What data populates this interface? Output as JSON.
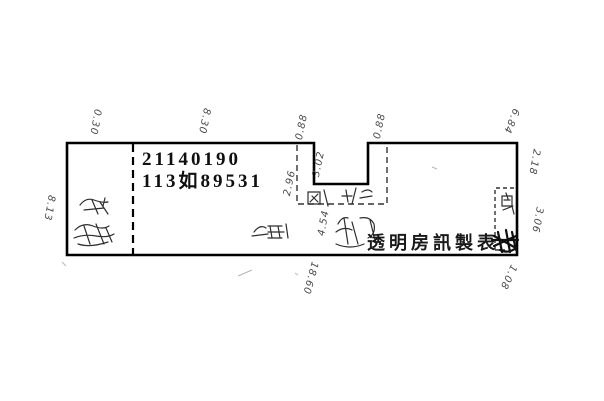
{
  "page": {
    "background_color": "#ffffff",
    "line_color": "#000000",
    "annotation_color": "#4a4a4a"
  },
  "parcel": {
    "id_line1": "21140190",
    "id_line2": "113如89531",
    "stamp": "透明房訊製表"
  },
  "measurements": [
    {
      "name": "top-left-segment",
      "value": "0.30"
    },
    {
      "name": "top-main-segment",
      "value": "8.30"
    },
    {
      "name": "notch-left-top",
      "value": "0.88"
    },
    {
      "name": "notch-right-top",
      "value": "0.88"
    },
    {
      "name": "top-right-segment",
      "value": "6.84"
    },
    {
      "name": "notch-depth",
      "value": "3.02"
    },
    {
      "name": "notch-area-left",
      "value": "2.96"
    },
    {
      "name": "notch-area-bottom",
      "value": "4.54"
    },
    {
      "name": "right-upper-segment",
      "value": "2.18"
    },
    {
      "name": "right-lower-segment",
      "value": "3.06"
    },
    {
      "name": "right-bottom-corner",
      "value": "1.08"
    },
    {
      "name": "bottom-width",
      "value": "18.60"
    },
    {
      "name": "left-depth",
      "value": "8.13"
    }
  ]
}
